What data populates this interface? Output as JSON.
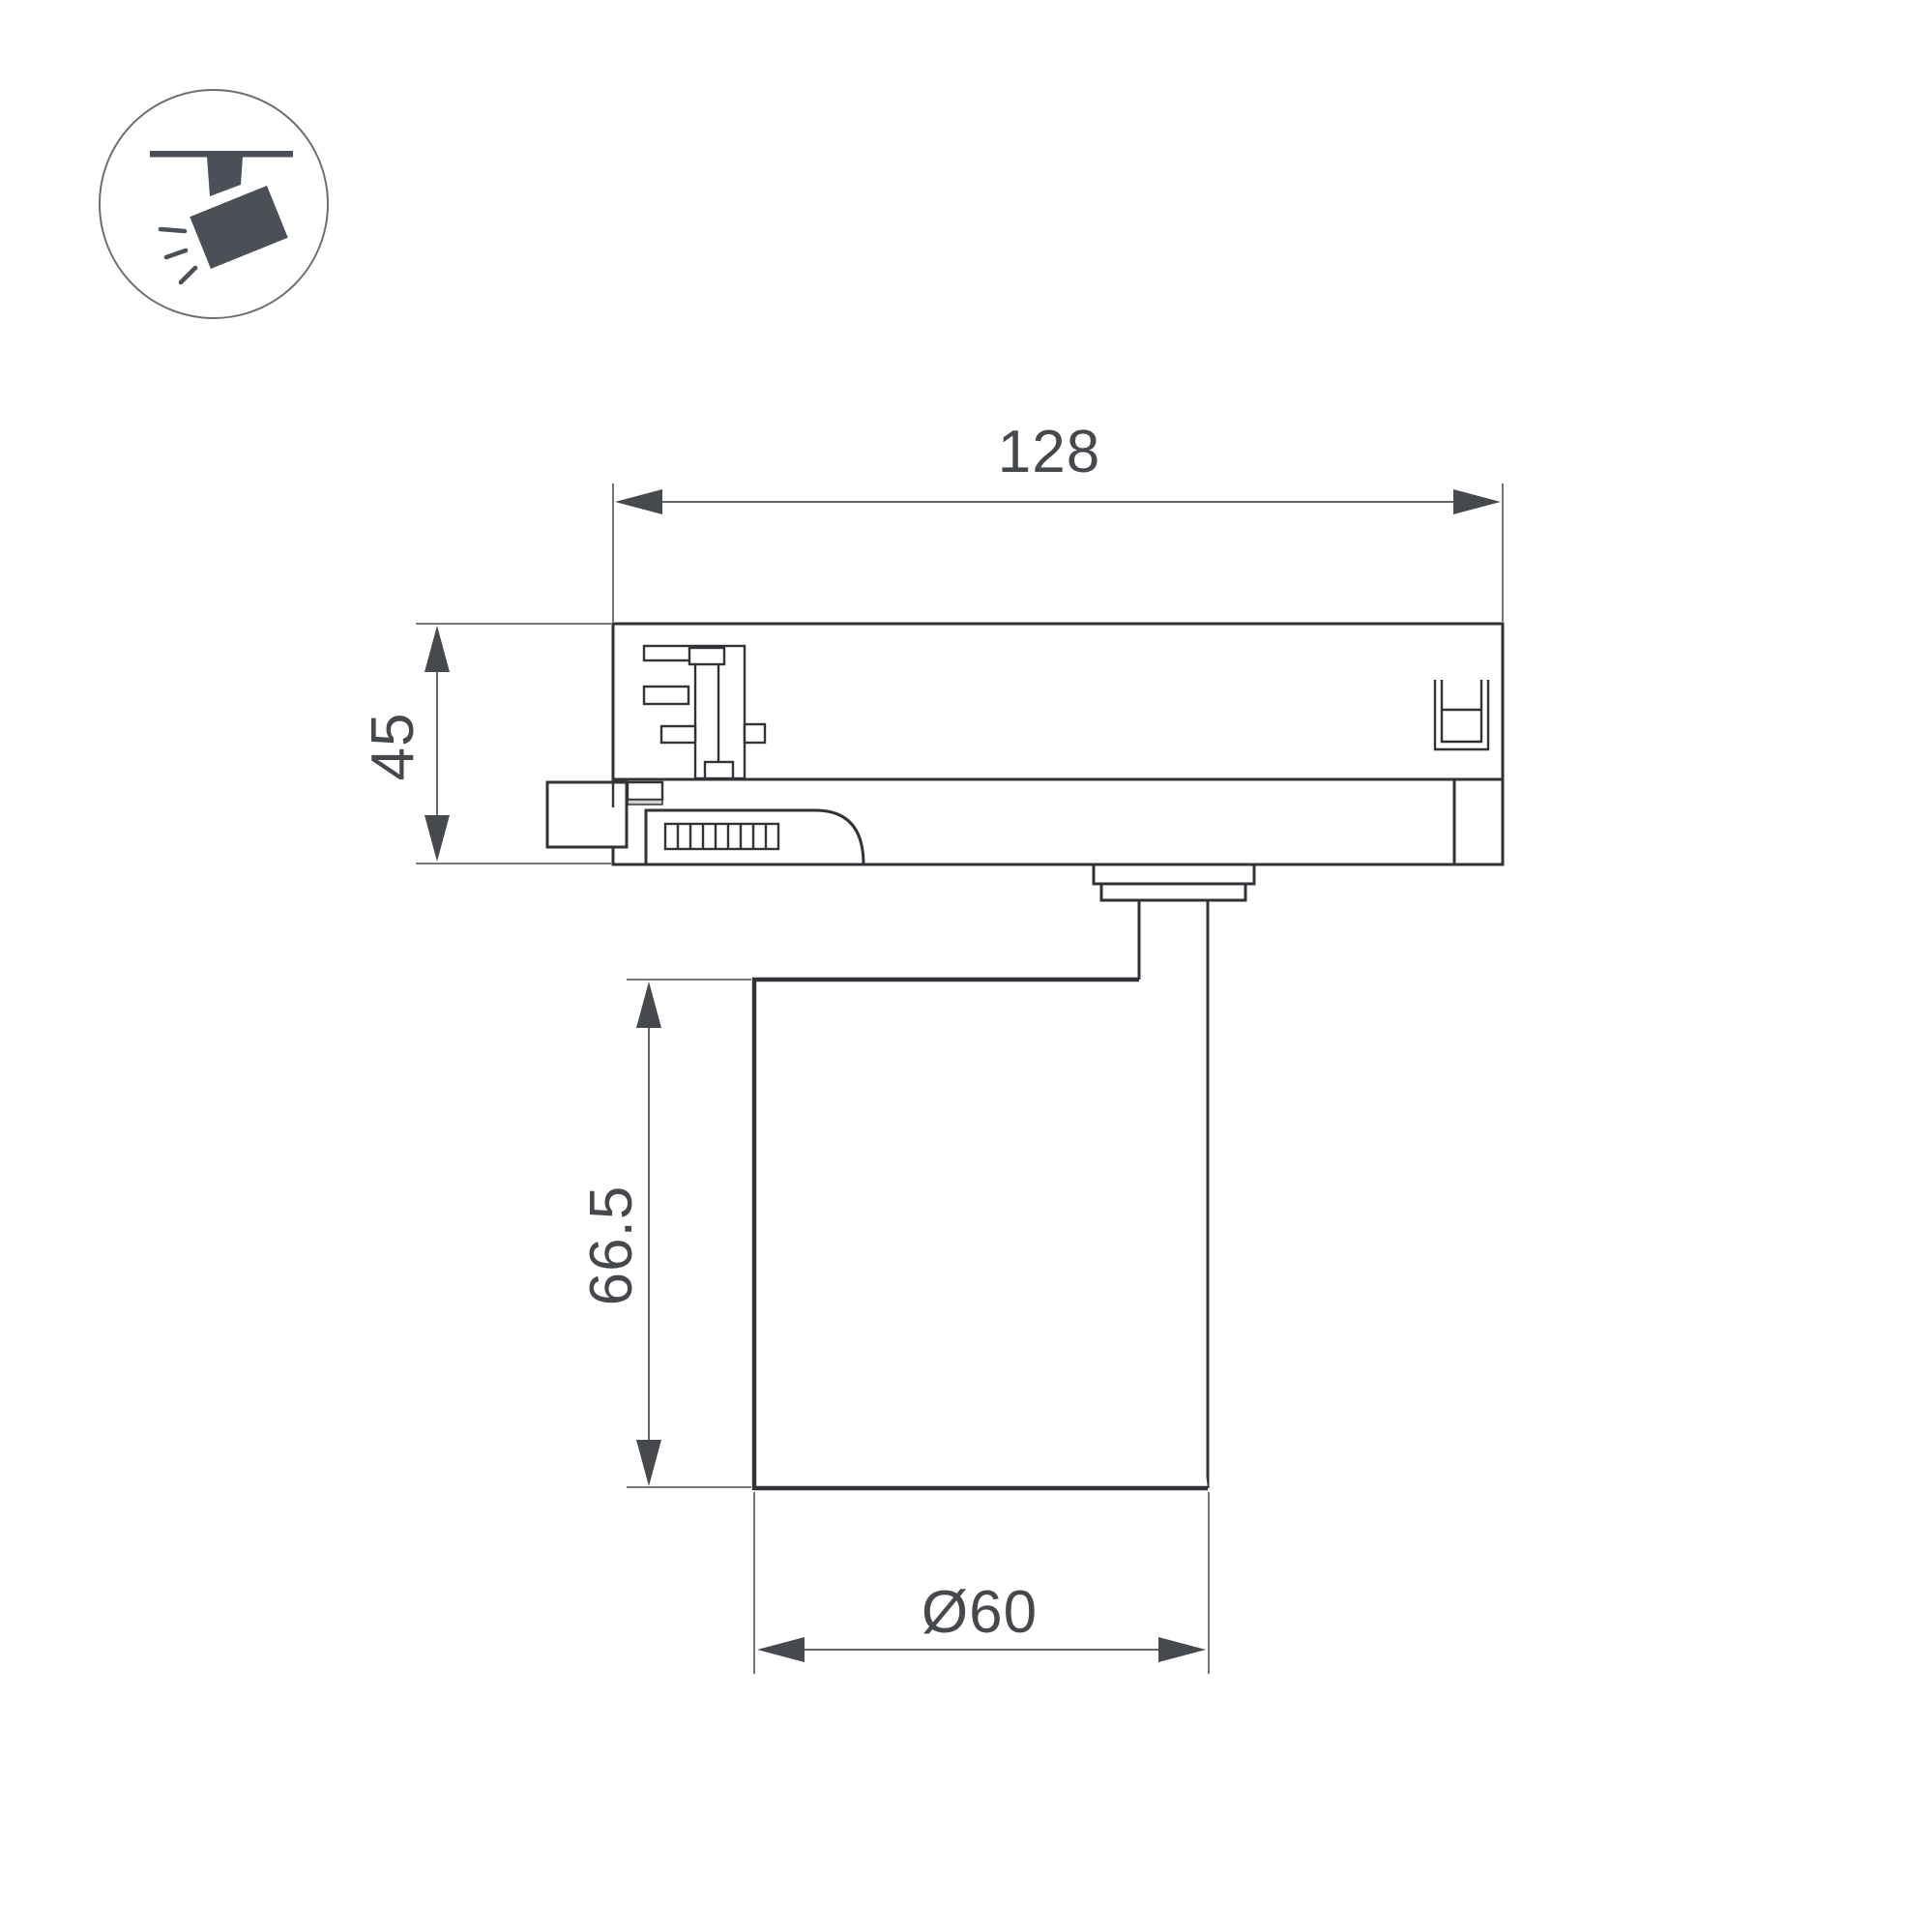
{
  "meta": {
    "background": "#ffffff",
    "description_visible_content": "technical dimension drawing of a track-mounted spotlight"
  },
  "icon": {
    "name": "track-spotlight",
    "glyph_color": "#4a5056",
    "circle_stroke": "#6b6f73"
  },
  "drawing": {
    "outline_color": "#303438",
    "dimension_color": "#63676b",
    "arrow_color": "#464a4e",
    "text_color": "#45494d"
  },
  "dimensions": {
    "track_width": "128",
    "adapter_height": "45",
    "body_height": "66.5",
    "body_diameter": "Ø60"
  }
}
